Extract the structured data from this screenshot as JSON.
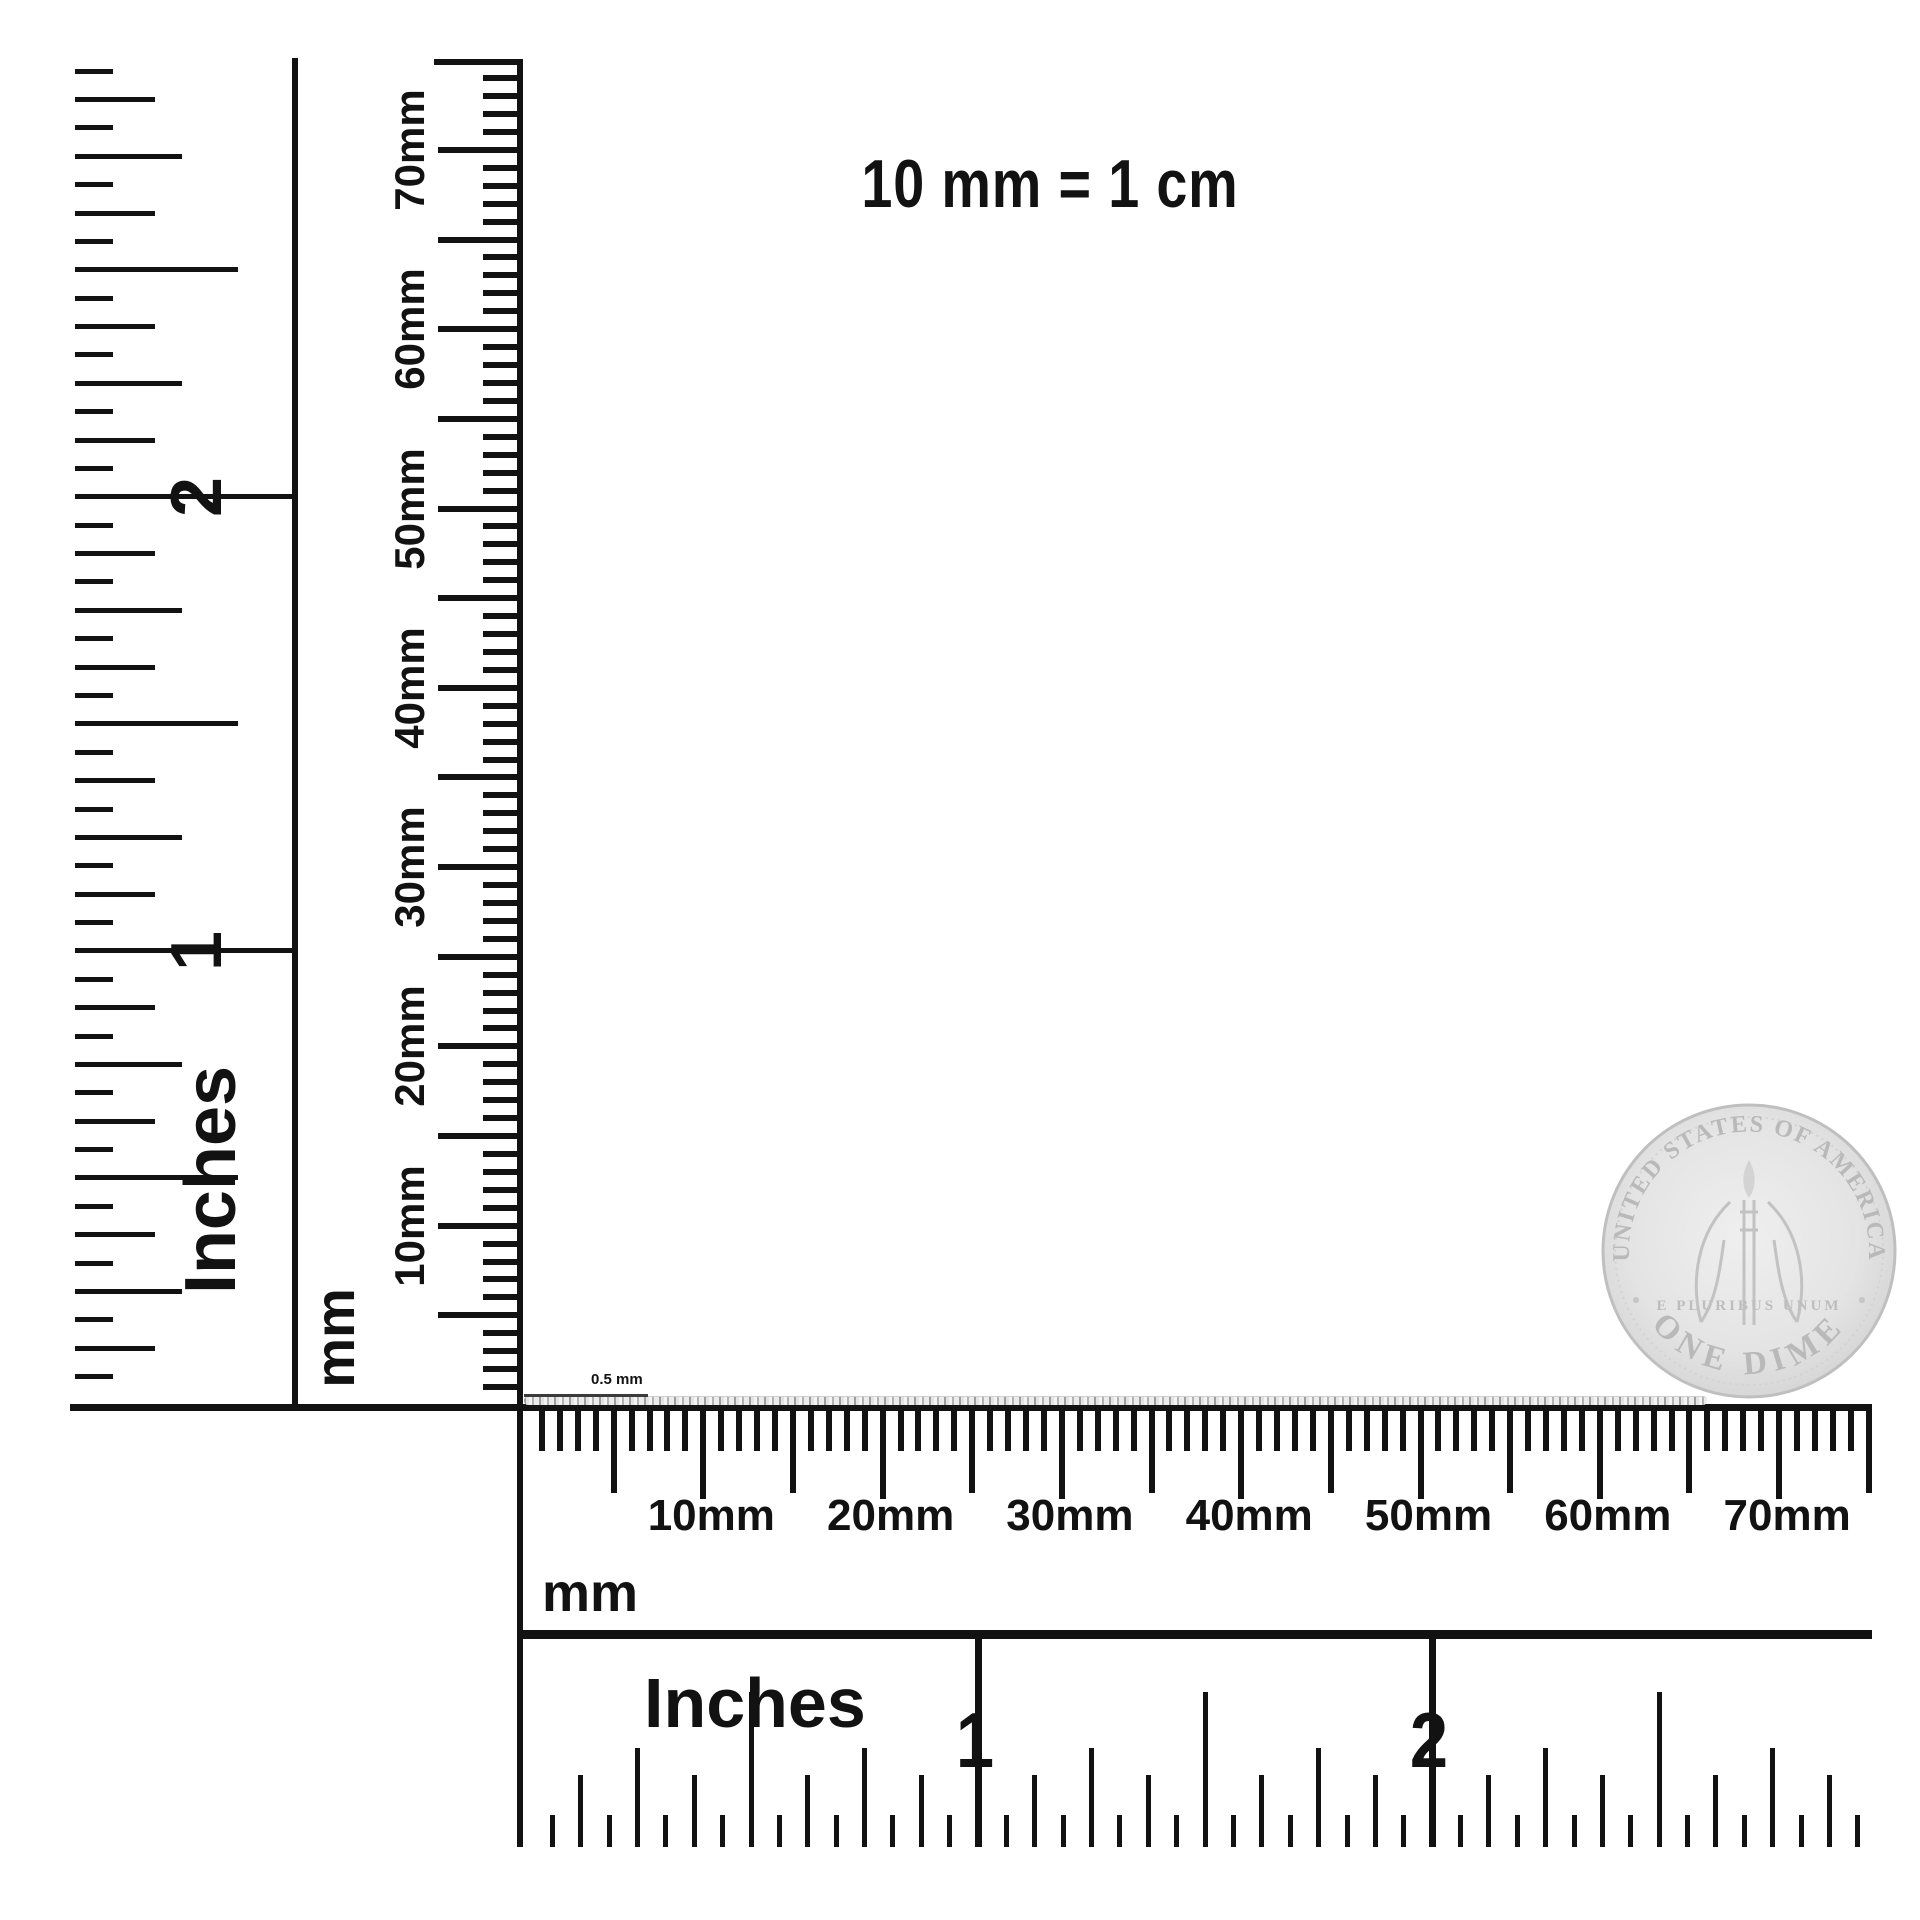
{
  "title": "10 mm = 1 cm",
  "left_ruler": {
    "inches": {
      "axis_label": "Inches",
      "numbers": [
        "1",
        "2"
      ]
    },
    "mm": {
      "axis_label": "mm",
      "labels": [
        "10mm",
        "20mm",
        "30mm",
        "40mm",
        "50mm",
        "60mm",
        "70mm"
      ]
    }
  },
  "bottom_ruler": {
    "mm": {
      "axis_label": "mm",
      "labels": [
        "10mm",
        "20mm",
        "30mm",
        "40mm",
        "50mm",
        "60mm",
        "70mm"
      ]
    },
    "inches": {
      "axis_label": "Inches",
      "numbers": [
        "1",
        "2"
      ]
    }
  },
  "chain": {
    "size_label": "0.5 mm"
  },
  "coin": {
    "legend_top": "UNITED STATES OF AMERICA",
    "denomination": "ONE DIME",
    "motto": "E PLURIBUS UNUM"
  },
  "colors": {
    "ink": "#121212",
    "chain": "#b9b9b9",
    "coin_face": "#e4e4e4",
    "coin_detail": "#c2c2c2"
  }
}
